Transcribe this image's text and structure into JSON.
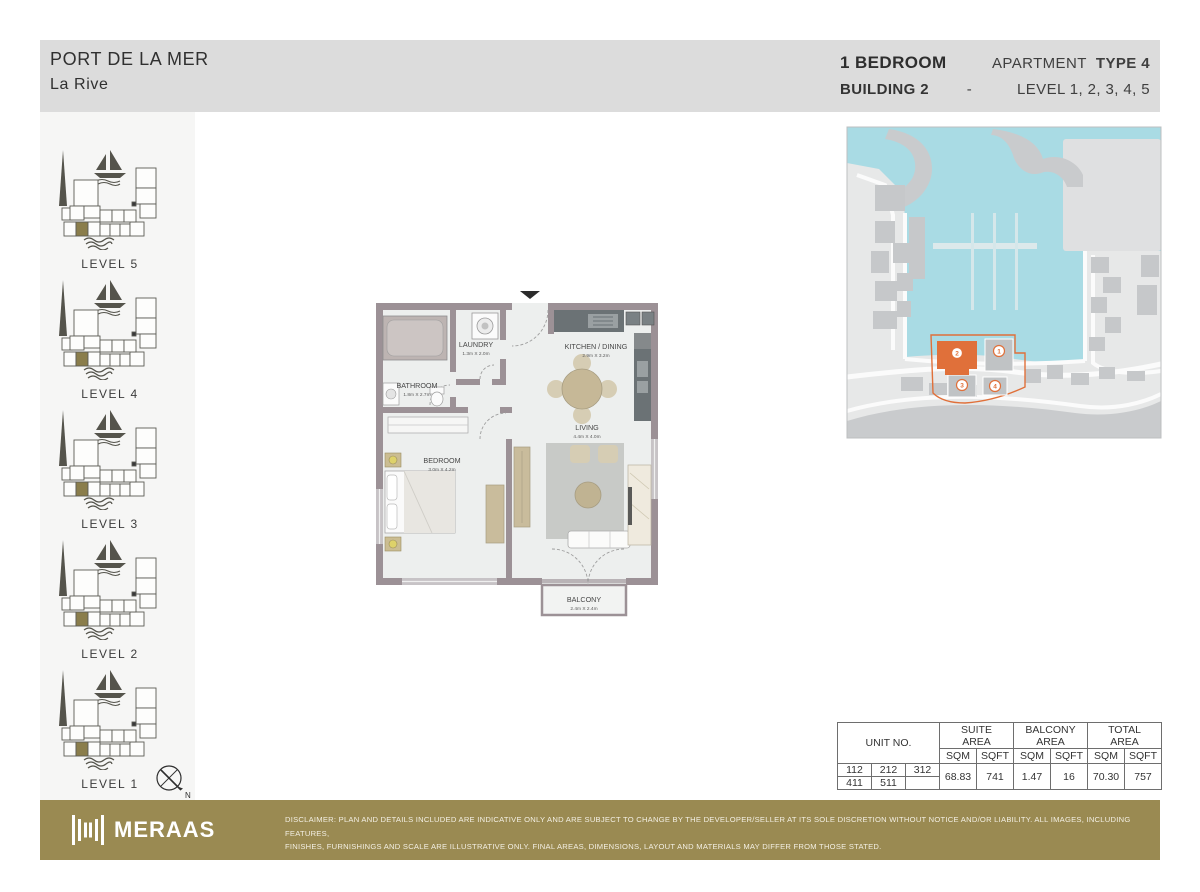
{
  "header": {
    "project_title": "PORT DE LA MER",
    "project_subtitle": "La  Rive",
    "unit_type": "1 BEDROOM",
    "apartment_label": "APARTMENT",
    "type_label": "TYPE 4",
    "building": "BUILDING 2",
    "separator": "-",
    "levels": "LEVEL 1, 2, 3, 4, 5"
  },
  "sidebar": {
    "levels": [
      {
        "label": "LEVEL 5"
      },
      {
        "label": "LEVEL 4"
      },
      {
        "label": "LEVEL 3"
      },
      {
        "label": "LEVEL 2"
      },
      {
        "label": "LEVEL 1"
      }
    ],
    "compass_label": "N"
  },
  "floor_plan": {
    "entrance_marker": "entry-arrow",
    "rooms": [
      {
        "name": "LAUNDRY",
        "dimensions": "1.3m X 2.0m"
      },
      {
        "name": "BATHROOM",
        "dimensions": "1.8m X 2.7m"
      },
      {
        "name": "KITCHEN / DINING",
        "dimensions": "2.9m X 3.2m"
      },
      {
        "name": "LIVING",
        "dimensions": "4.4m X 4.0m"
      },
      {
        "name": "BEDROOM",
        "dimensions": "3.0m X 4.2m"
      },
      {
        "name": "BALCONY",
        "dimensions": "2.4m X 2.4m"
      }
    ]
  },
  "site_map": {
    "markers": [
      "1",
      "2",
      "3",
      "4"
    ],
    "highlighted_building": "2",
    "colors": {
      "water": "#a9dbe4",
      "land": "#e7e8e8",
      "building": "#c6c8ca",
      "highlight": "#e0703a"
    }
  },
  "area_table": {
    "unit_header": "UNIT NO.",
    "suite_header": "SUITE\nAREA",
    "balcony_header": "BALCONY\nAREA",
    "total_header": "TOTAL\nAREA",
    "sqm_label": "SQM",
    "sqft_label": "SQFT",
    "units": [
      [
        "112",
        "212",
        "312"
      ],
      [
        "411",
        "511",
        ""
      ]
    ],
    "suite_sqm": "68.83",
    "suite_sqft": "741",
    "balcony_sqm": "1.47",
    "balcony_sqft": "16",
    "total_sqm": "70.30",
    "total_sqft": "757"
  },
  "footer": {
    "brand": "MERAAS",
    "disclaimer_line1": "DISCLAIMER: PLAN AND DETAILS INCLUDED ARE INDICATIVE ONLY AND ARE SUBJECT TO CHANGE BY THE DEVELOPER/SELLER AT ITS SOLE DISCRETION WITHOUT NOTICE AND/OR LIABILITY. ALL IMAGES, INCLUDING FEATURES,",
    "disclaimer_line2": "FINISHES, FURNISHINGS AND SCALE ARE ILLUSTRATIVE ONLY. FINAL AREAS, DIMENSIONS, LAYOUT AND MATERIALS MAY DIFFER FROM THOSE STATED."
  },
  "colors": {
    "header_band": "#dcdcdc",
    "sidebar_bg": "#f6f6f5",
    "footer_gold": "#9a8a52",
    "wall": "#9c9196",
    "accent_orange": "#e0703a"
  }
}
